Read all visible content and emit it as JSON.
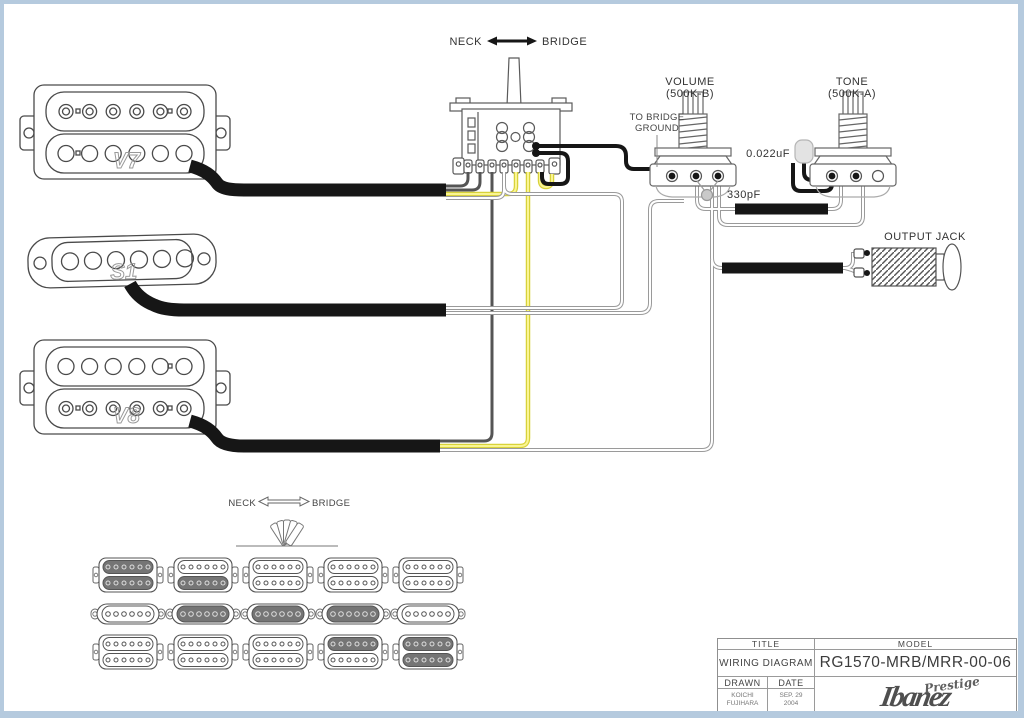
{
  "colors": {
    "outline": "#444444",
    "wire_black": "#161616",
    "wire_gray": "#555555",
    "wire_yellow": "#efe94c",
    "wire_white": "#ffffff",
    "wire_casing": "#9a9a9a",
    "active_shade": "#757575",
    "frame_border": "#b5cade",
    "cap_body": "#e3e3e3"
  },
  "switch": {
    "neck_label": "NECK",
    "bridge_label": "BRIDGE"
  },
  "pickups": {
    "neck": "V7",
    "middle": "S1",
    "bridge": "V8"
  },
  "controls": {
    "volume_label": "VOLUME",
    "volume_value": "(500K-B)",
    "tone_label": "TONE",
    "tone_value": "(500K-A)",
    "tone_cap_value": "0.022uF",
    "volume_cap_value": "330pF",
    "bridge_ground_line1": "TO BRIDGE",
    "bridge_ground_line2": "GROUND",
    "output_jack_label": "OUTPUT JACK"
  },
  "selector_guide": {
    "neck_label": "NECK",
    "bridge_label": "BRIDGE",
    "positions": [
      {
        "neck": "both",
        "middle": false,
        "bridge": "none"
      },
      {
        "neck": "bottom",
        "middle": true,
        "bridge": "none"
      },
      {
        "neck": "none",
        "middle": true,
        "bridge": "none"
      },
      {
        "neck": "none",
        "middle": true,
        "bridge": "top"
      },
      {
        "neck": "none",
        "middle": false,
        "bridge": "both"
      }
    ]
  },
  "title_block": {
    "title_header": "TITLE",
    "model_header": "MODEL",
    "title_value": "WIRING DIAGRAM",
    "model_value": "RG1570-MRB/MRR-00-06",
    "drawn_header": "DRAWN",
    "date_header": "DATE",
    "drawn_value_line1": "KOICHI",
    "drawn_value_line2": "FUJIHARA",
    "date_value_line1": "SEP. 29",
    "date_value_line2": "2004",
    "brand": "Ibanez",
    "brand_script": "Prestige"
  }
}
